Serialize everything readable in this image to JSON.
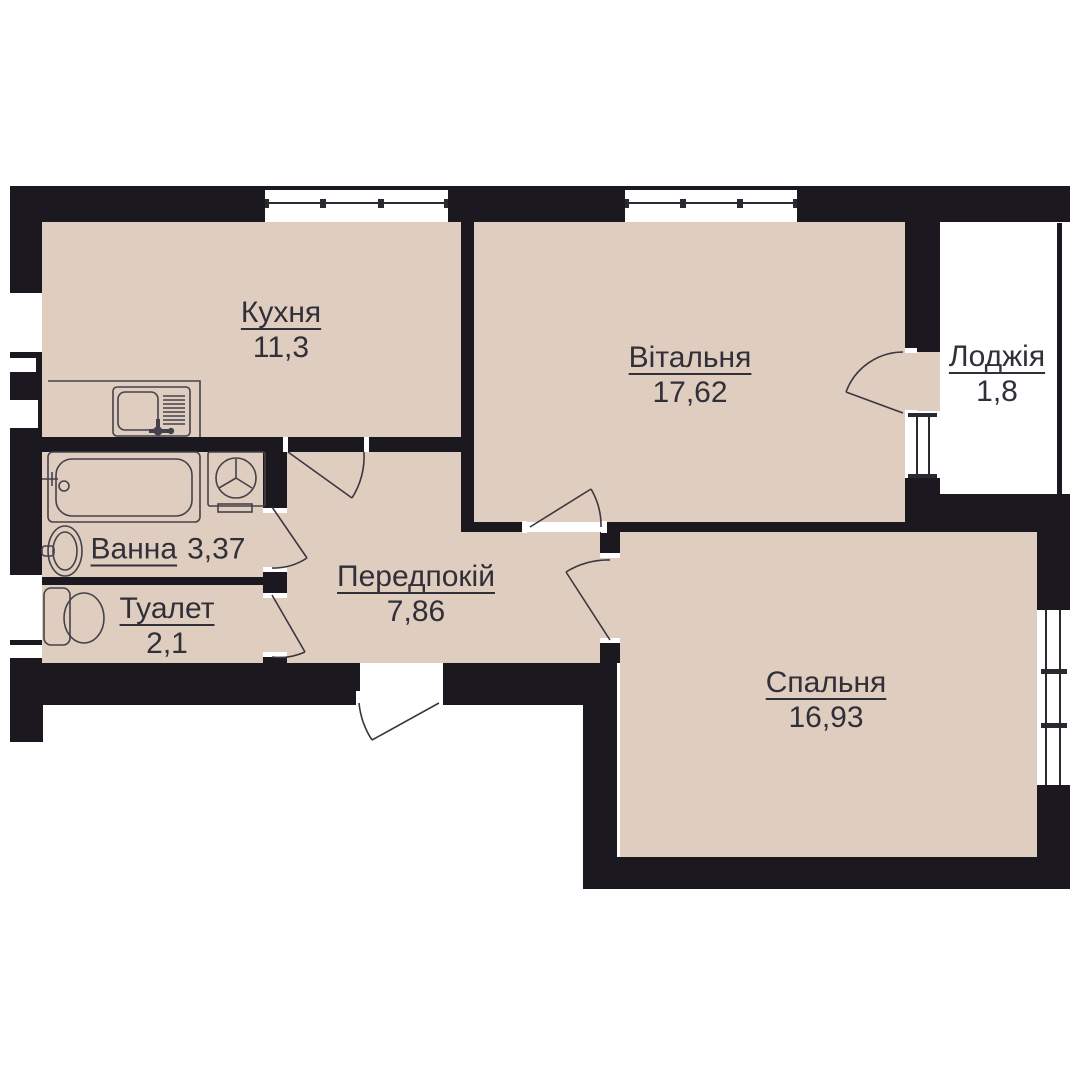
{
  "plan": {
    "title": "apartment-floor-plan",
    "rooms": [
      {
        "id": "kitchen",
        "name": "Кухня",
        "area": "11,3"
      },
      {
        "id": "living",
        "name": "Вітальня",
        "area": "17,62"
      },
      {
        "id": "loggia",
        "name": "Лоджія",
        "area": "1,8"
      },
      {
        "id": "bath",
        "name": "Ванна",
        "area": "3,37"
      },
      {
        "id": "toilet",
        "name": "Туалет",
        "area": "2,1"
      },
      {
        "id": "hall",
        "name": "Передпокій",
        "area": "7,86"
      },
      {
        "id": "bedroom",
        "name": "Спальня",
        "area": "16,93"
      }
    ],
    "colors": {
      "wall": "#1b191f",
      "floor": "#dfcec0",
      "door_line": "#3b3740",
      "fixture_line": "#45414b",
      "window_line": "#2b2930",
      "text": "#312f38",
      "opening": "#ffffff"
    }
  }
}
